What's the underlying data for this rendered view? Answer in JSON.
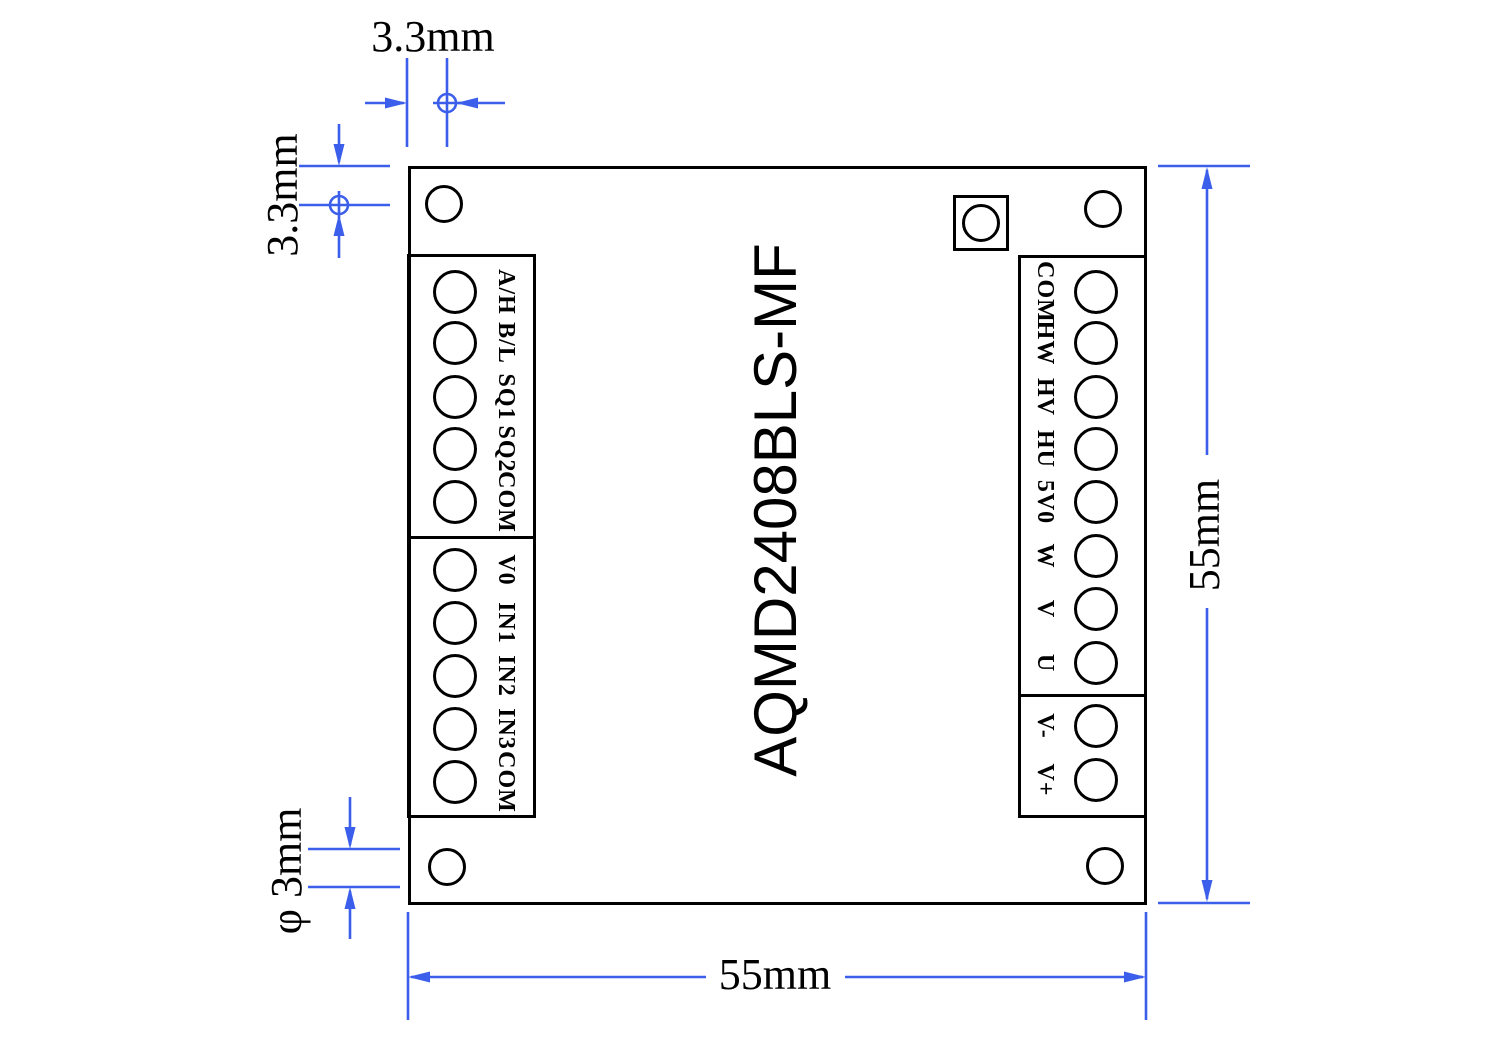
{
  "board": {
    "title": "AQMD2408BLS-MF",
    "left_block_top": {
      "labels": [
        "A/H",
        "B/L",
        "SQ1",
        "SQ2",
        "COM"
      ]
    },
    "left_block_bottom": {
      "labels": [
        "V0",
        "IN1",
        "IN2",
        "IN3",
        "COM"
      ]
    },
    "right_block_top": {
      "labels": [
        "COM",
        "HW",
        "HV",
        "HU",
        "5V0",
        "W",
        "V",
        "U"
      ]
    },
    "right_block_bottom": {
      "labels": [
        "V-",
        "V+"
      ]
    }
  },
  "dimensions": {
    "top_offset": "3.3mm",
    "left_offset": "3.3mm",
    "hole_diameter": "φ 3mm",
    "board_width": "55mm",
    "board_height": "55mm"
  },
  "colors": {
    "dimension_line": "#3B5EEB",
    "outline": "#000000"
  }
}
